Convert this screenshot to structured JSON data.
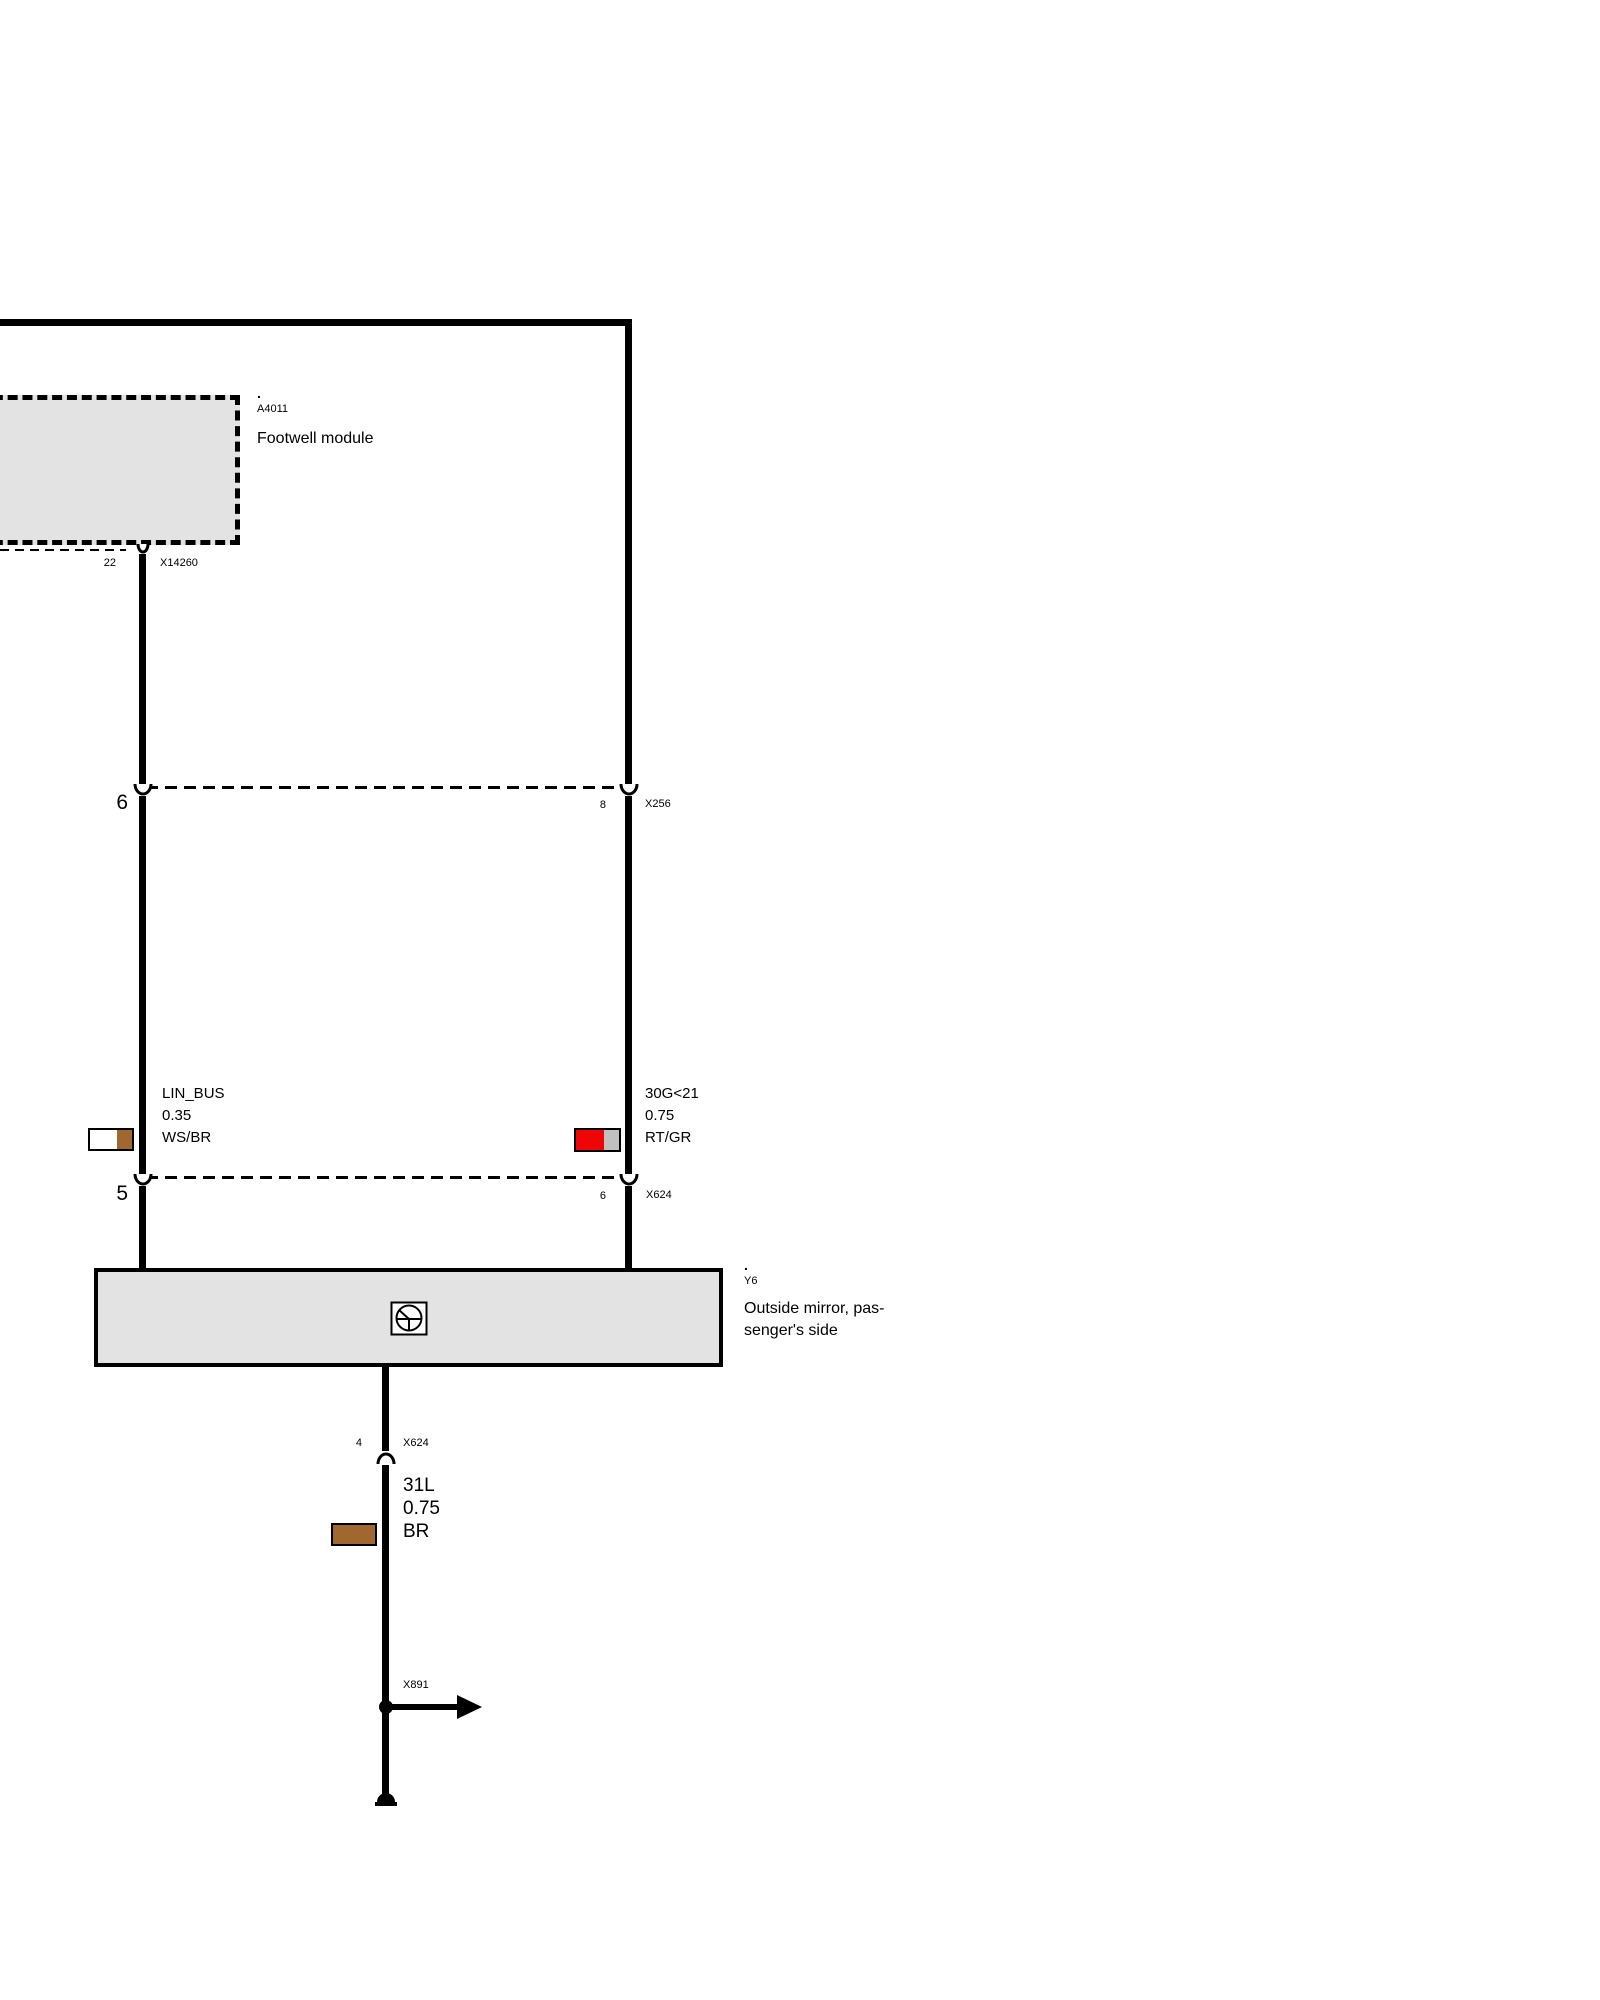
{
  "modules": {
    "footwell": {
      "dot": ".",
      "code": "A4011",
      "name": "Footwell module"
    },
    "mirror": {
      "dot": ".",
      "code": "Y6",
      "name_line1": "Outside mirror, pas-",
      "name_line2": "senger's side"
    }
  },
  "connectors": {
    "x14260": {
      "pin": "22",
      "name": "X14260"
    },
    "x256": {
      "pin_left": "6",
      "pin_right": "8",
      "name": "X256"
    },
    "x624_mid": {
      "pin_left": "5",
      "pin_right": "6",
      "name": "X624"
    },
    "x624_mirror": {
      "pin": "4",
      "name": "X624"
    },
    "x891": {
      "name": "X891"
    }
  },
  "wires": {
    "lin_bus": {
      "signal": "LIN_BUS",
      "size": "0.35",
      "color_code": "WS/BR"
    },
    "g30": {
      "signal": "30G<21",
      "size": "0.75",
      "color_code": "RT/GR"
    },
    "l31": {
      "signal": "31L",
      "size": "0.75",
      "color_code": "BR"
    }
  },
  "colors": {
    "white": "#ffffff",
    "brown": "#a0682e",
    "red": "#ee0505",
    "gray": "#c0c0c0",
    "module_fill": "#e3e3e3",
    "wire": "#000000"
  },
  "icons": {
    "motor": "mirror-motor-icon",
    "ground": "ground-icon",
    "branch_arrow": "branch-arrow-icon"
  }
}
